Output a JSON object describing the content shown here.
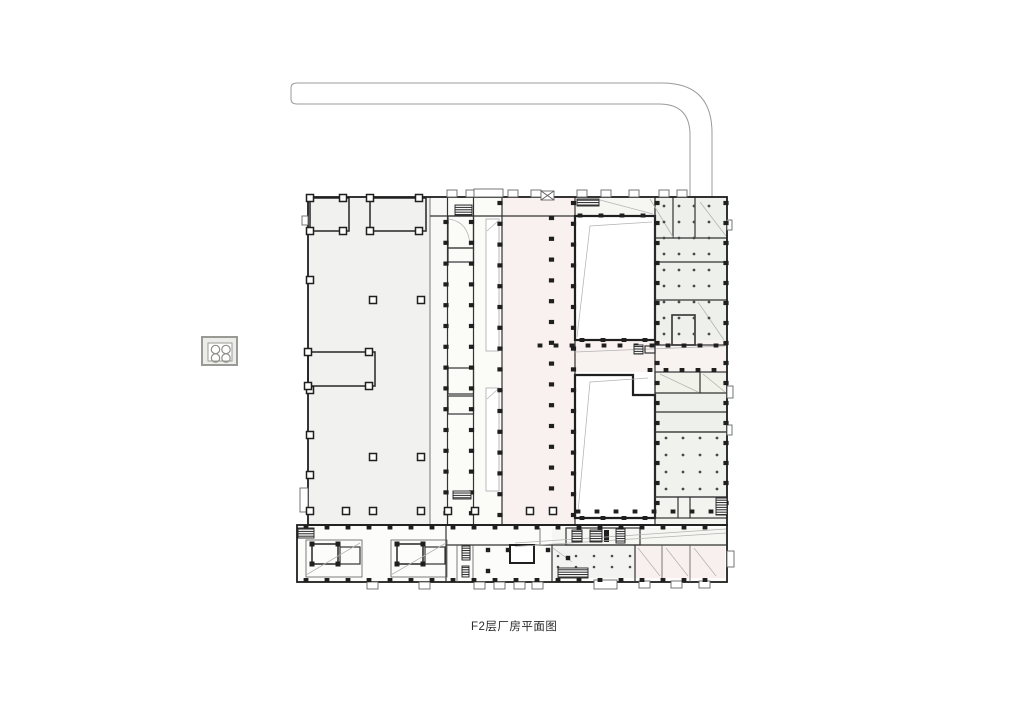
{
  "document": {
    "caption": "F2层厂房平面图"
  },
  "palette": {
    "paper": "#ffffff",
    "ink": "#1f1f1f",
    "wall": "#333333",
    "ramp": "#9b9b9b",
    "sweep": "#b3b3b3",
    "hall_fill": "#f1f1ef",
    "corridor_fill": "#f9f1f0",
    "cream_fill": "#f5f3e6",
    "green_fill": "#eef0ec",
    "green_fill_2": "#f0f2ee",
    "pink_fill": "#f8f0ef",
    "light_fill": "#f6f6f3",
    "band_fill": "#fcfcfa"
  },
  "icons": {
    "stairs": "stairs-hatch-icon",
    "elevator": "elevator-x-icon",
    "equipment": "equipment-pad-icon",
    "ramp": "vehicle-ramp"
  }
}
